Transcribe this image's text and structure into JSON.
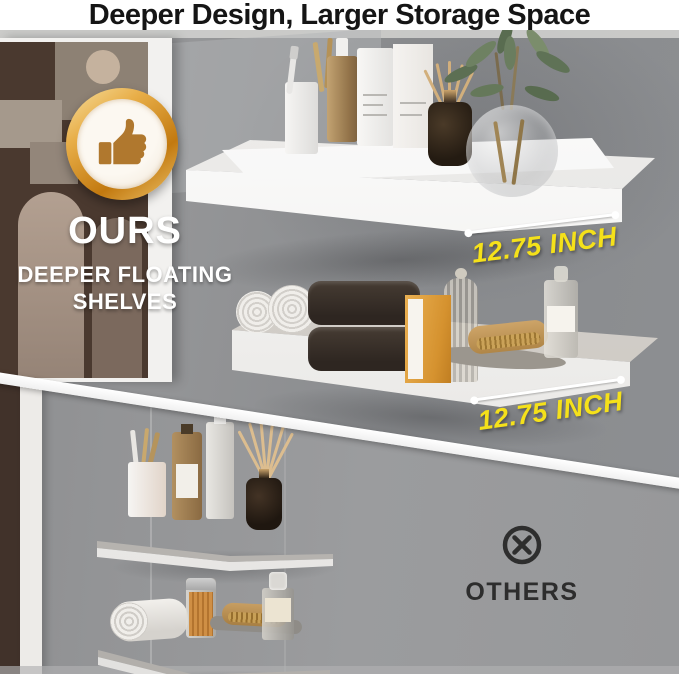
{
  "header": {
    "title": "Deeper Design, Larger Storage Space"
  },
  "ours": {
    "label": "OURS",
    "subtitle_line1": "DEEPER FLOATING",
    "subtitle_line2": "SHELVES",
    "measurements": [
      "12.75 INCH",
      "12.75 INCH"
    ],
    "badge_icon": "thumbs-up-icon"
  },
  "others": {
    "label": "OTHERS",
    "icon": "x-circle-icon"
  },
  "colors": {
    "accent_yellow": "#F5E11A",
    "badge_gold": "#D4921F",
    "title_text": "#151515",
    "others_text": "#2D2D2D",
    "wall_gray_top": "#8E9093",
    "wall_gray_bottom": "#98999B",
    "shelf_white": "#FAFAF9"
  }
}
